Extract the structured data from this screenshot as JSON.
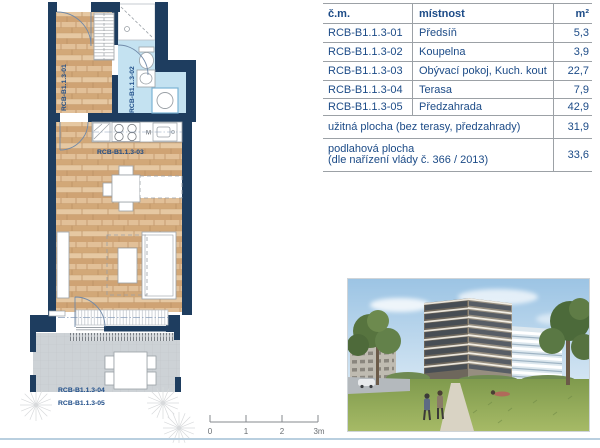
{
  "plan": {
    "unit_labels": {
      "hall": "RCB-B1.1.3-01",
      "bath": "RCB-B1.1.3-02",
      "living": "RCB-B1.1.3-03",
      "terrace": "RCB-B1.1.3-04",
      "garden": "RCB-B1.1.3-05"
    },
    "kitchen_microwave_label": "M",
    "colors": {
      "wall": "#1e3d5f",
      "wood_floor": "#dcb68c",
      "bath_floor": "#c4e2f1",
      "terrace_floor": "#cdd2d6",
      "label_text": "#1c4b87"
    }
  },
  "area_table": {
    "headers": {
      "code": "č.m.",
      "room": "místnost",
      "area": "m²"
    },
    "rows": [
      {
        "code": "RCB-B1.1.3-01",
        "room": "Předsíň",
        "area": "5,3"
      },
      {
        "code": "RCB-B1.1.3-02",
        "room": "Koupelna",
        "area": "3,9"
      },
      {
        "code": "RCB-B1.1.3-03",
        "room": "Obývací pokoj, Kuch. kout",
        "area": "22,7"
      },
      {
        "code": "RCB-B1.1.3-04",
        "room": "Terasa",
        "area": "7,9"
      },
      {
        "code": "RCB-B1.1.3-05",
        "room": "Předzahrada",
        "area": "42,9"
      }
    ],
    "summary_useful": {
      "label": "užitná plocha (bez terasy, předzahrady)",
      "area": "31,9"
    },
    "summary_floor": {
      "label_line1": "podlahová plocha",
      "label_line2": "(dle nařízení vlády č. 366 / 2013)",
      "area": "33,6"
    },
    "text_color": "#1c4b87",
    "border_color": "#9ca1a6"
  },
  "scale_bar": {
    "ticks": [
      "0",
      "1",
      "2",
      "3m"
    ]
  }
}
